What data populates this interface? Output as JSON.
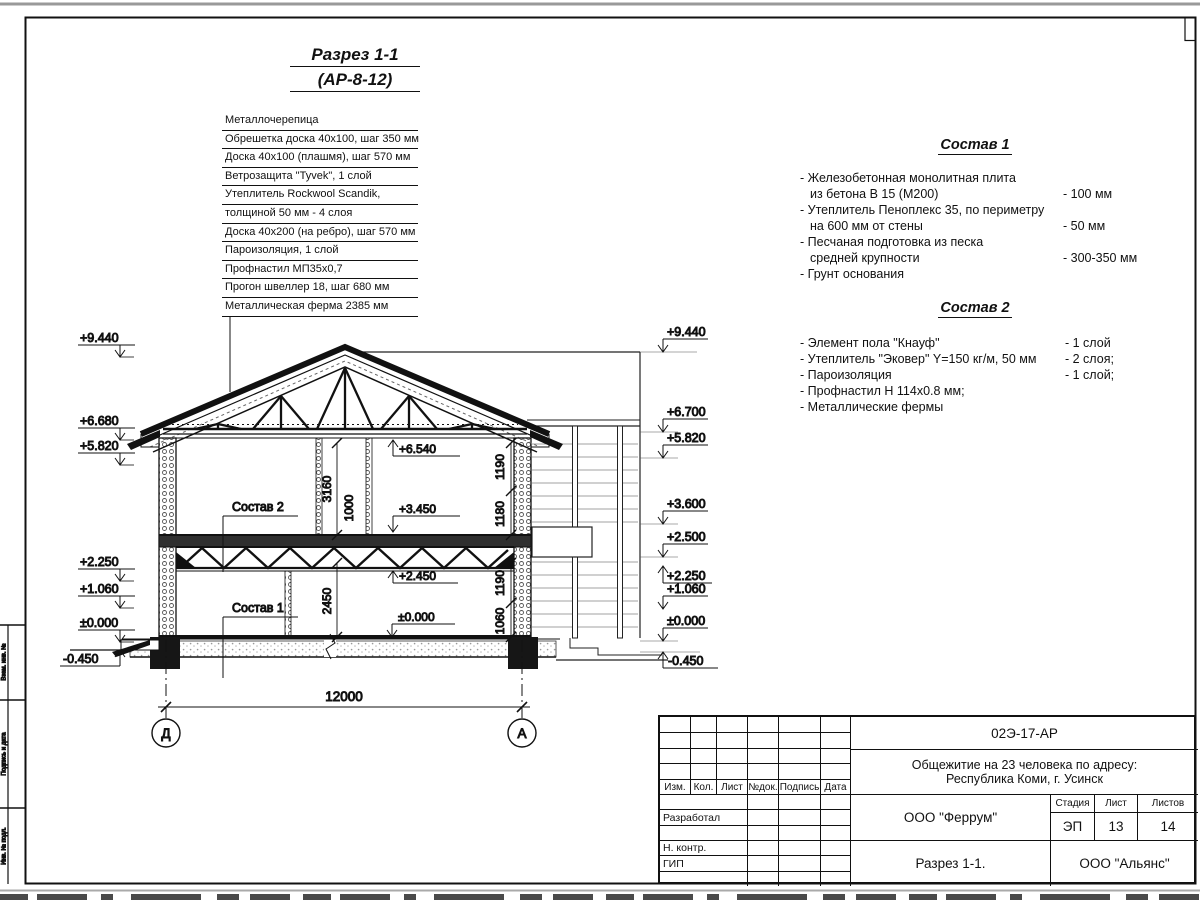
{
  "page": {
    "title_line1": "Разрез 1-1",
    "title_line2": "(АР-8-12)"
  },
  "roof_layers": {
    "top_label": "Металлочерепица",
    "rows": [
      "Обрешетка доска 40х100, шаг 350 мм",
      "Доска 40х100 (плашмя), шаг 570 мм",
      "Ветрозащита \"Tyvek\", 1 слой",
      "Утеплитель Rockwool Scandik,",
      "толщиной 50 мм - 4 слоя",
      "Доска 40х200 (на ребро), шаг 570 мм",
      "Пароизоляция, 1 слой",
      "Профнастил МП35х0,7",
      "Прогон швеллер 18, шаг 680 мм",
      "Металлическая ферма 2385 мм"
    ]
  },
  "sostav1": {
    "title": "Состав 1",
    "lines": [
      "- Железобетонная  монолитная плита",
      "из бетона В 15 (М200)",
      "- Утеплитель Пеноплекс 35, по периметру",
      "на 600 мм от стены",
      "- Песчаная подготовка из песка",
      "средней крупности",
      "- Грунт основания"
    ],
    "values": [
      "- 100 мм",
      "- 50 мм",
      "- 300-350 мм"
    ]
  },
  "sostav2": {
    "title": "Состав 2",
    "lines": [
      "- Элемент пола \"Кнауф\"",
      "- Утеплитель \"Эковер\" Y=150 кг/м, 50 мм",
      "- Пароизоляция",
      "- Профнастил Н 114х0.8 мм;",
      "- Металлические фермы"
    ],
    "values": [
      "- 1 слой",
      "- 2 слоя;",
      "- 1 слой;"
    ]
  },
  "elevations": {
    "left": [
      "+9.440",
      "+6.680",
      "+5.820",
      "+2.250",
      "+1.060",
      "±0.000",
      "-0.450"
    ],
    "right": [
      "+9.440",
      "+6.700",
      "+5.820",
      "+3.600",
      "+2.500",
      "+2.250",
      "+1.060",
      "±0.000",
      "-0.450"
    ]
  },
  "section": {
    "floor2_label": "Состав 2",
    "floor1_label": "Состав 1",
    "elev_ceiling2": "+6.540",
    "elev_floor2": "+3.450",
    "elev_ceiling1": "+2.450",
    "elev_floor1": "±0.000",
    "dim_room2_h": "3160",
    "dim_corridor": "1000",
    "dim_room1_h": "2450",
    "dim_r2a": "1190",
    "dim_r2b": "1180",
    "dim_r1a": "1190",
    "dim_r1b": "1060",
    "dim_span": "12000",
    "axis_left": "Д",
    "axis_right": "А"
  },
  "left_margin": {
    "cells": [
      "Взам. инв. №",
      "Подпись и дата",
      "Инв. № подл."
    ]
  },
  "title_block": {
    "doc_number": "02Э-17-АР",
    "project_line1": "Общежитие на 23 человека по адресу:",
    "project_line2": "Республика Коми, г. Усинск",
    "designer_org": "ООО \"Феррум\"",
    "stage_label": "Стадия",
    "sheet_label": "Лист",
    "sheets_label": "Листов",
    "stage": "ЭП",
    "sheet": "13",
    "sheets": "14",
    "sheet_title": "Разрез 1-1.",
    "contractor_org": "ООО \"Альянс\"",
    "col_headers": [
      "Изм.",
      "Кол.",
      "Лист",
      "№док.",
      "Подпись",
      "Дата"
    ],
    "row_labels": [
      "Разработал",
      "Н. контр.",
      "ГИП"
    ]
  }
}
